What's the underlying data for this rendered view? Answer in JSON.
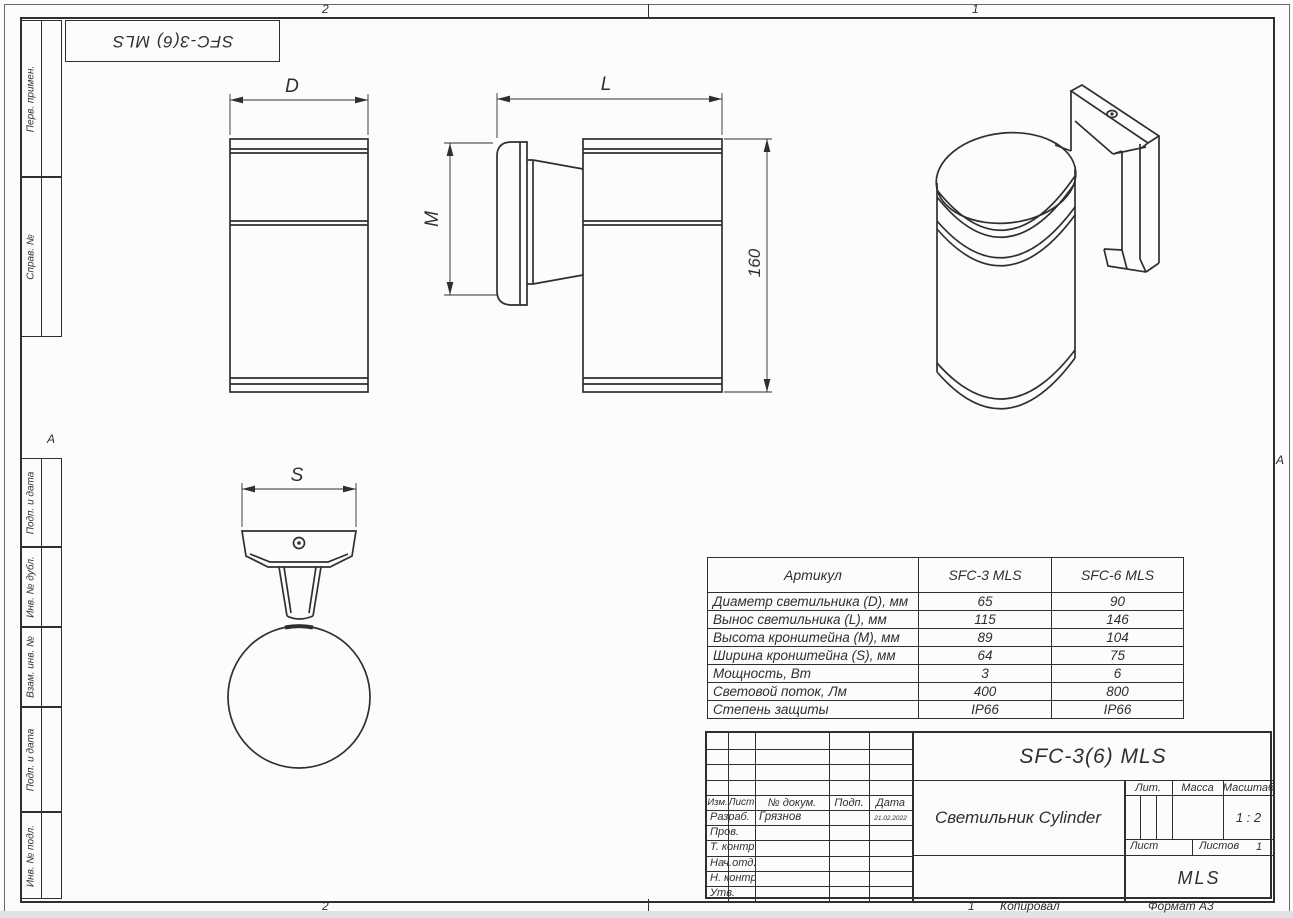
{
  "colors": {
    "line": "#2f2f2f",
    "scan_edge": "#dfe3e6"
  },
  "frame": {
    "zone_top_left": "2",
    "zone_top_right": "1",
    "zone_bottom_left": "2",
    "zone_marker_left": "А",
    "zone_marker_right": "А",
    "bottom_sheet_no": "1",
    "bottom_copied": "Копировал",
    "bottom_format": "Формат А3"
  },
  "corner_stamp": {
    "designation": "SFC-3(6) MLS"
  },
  "side_stamp": {
    "items": [
      "Перв. примен.",
      "Справ. №",
      "Подп. и дата",
      "Инв. № дубл.",
      "Взам. инв. №",
      "Подп. и дата",
      "Инв. № подл."
    ]
  },
  "drawing": {
    "dims": {
      "d": "D",
      "l": "L",
      "m": "M",
      "s": "S",
      "height": "160"
    }
  },
  "spec_table": {
    "header": [
      "Артикул",
      "SFC-3 MLS",
      "SFC-6 MLS"
    ],
    "rows": [
      [
        "Диаметр светильника (D), мм",
        "65",
        "90"
      ],
      [
        "Вынос светильника (L), мм",
        "115",
        "146"
      ],
      [
        "Высота кронштейна (M), мм",
        "89",
        "104"
      ],
      [
        "Ширина кронштейна (S), мм",
        "64",
        "75"
      ],
      [
        "Мощность, Вт",
        "3",
        "6"
      ],
      [
        "Световой поток, Лм",
        "400",
        "800"
      ],
      [
        "Степень защиты",
        "IP66",
        "IP66"
      ]
    ]
  },
  "title_block": {
    "designation": "SFC-3(6) MLS",
    "product_name": "Светильник Cylinder",
    "cols": {
      "izm": "Изм.",
      "list": "Лист",
      "doc": "№ докум.",
      "podp": "Подп.",
      "data": "Дата"
    },
    "rows": [
      {
        "label": "Разраб.",
        "name": "Грязнов",
        "date": "21.02.2022"
      },
      {
        "label": "Пров.",
        "name": "",
        "date": ""
      },
      {
        "label": "Т. контр.",
        "name": "",
        "date": ""
      },
      {
        "label": "Нач.отд.",
        "name": "",
        "date": ""
      },
      {
        "label": "Н. контр.",
        "name": "",
        "date": ""
      },
      {
        "label": "Утв.",
        "name": "",
        "date": ""
      }
    ],
    "lit_label": "Лит.",
    "mass_label": "Масса",
    "scale_label": "Масштаб",
    "scale_value": "1 : 2",
    "sheet_label": "Лист",
    "sheets_label": "Листов",
    "sheets_value": "1",
    "company": "MLS"
  }
}
